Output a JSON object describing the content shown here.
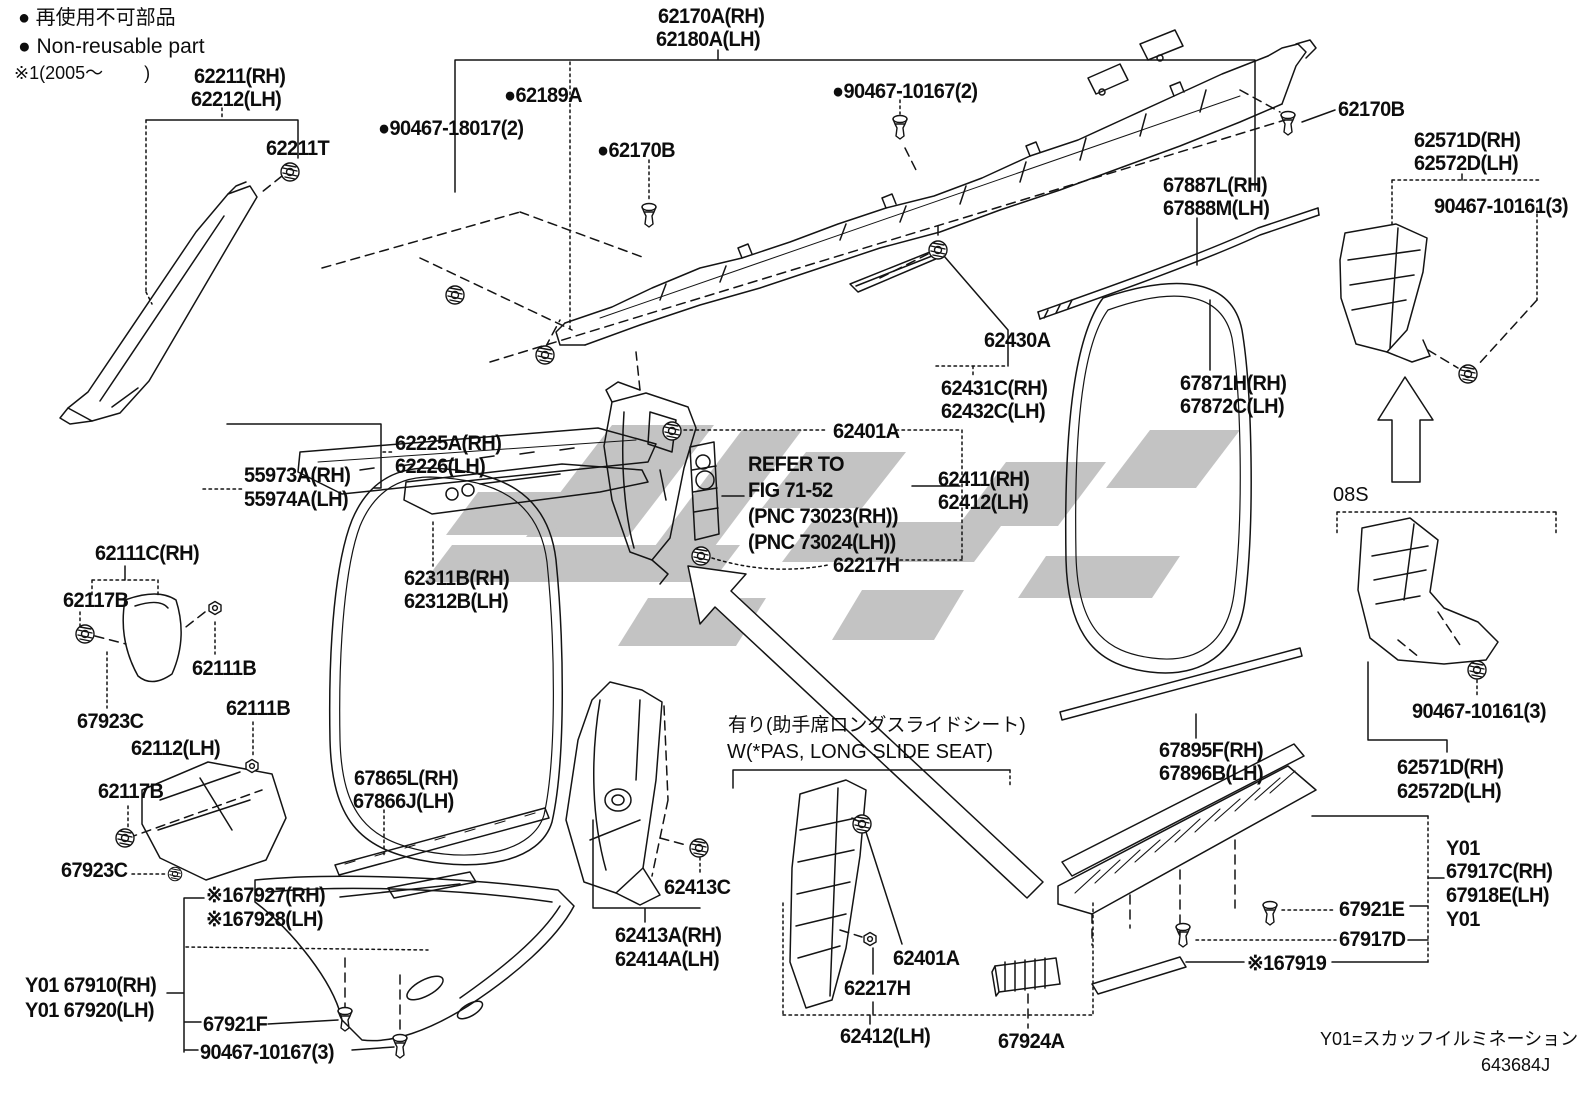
{
  "doc_type": "parts-diagram",
  "colors": {
    "line": "#141414",
    "watermark": "#c3c3c3",
    "background": "#ffffff"
  },
  "legend": {
    "nonreusable_jp": "● 再使用不可部品",
    "nonreusable_en": "● Non-reusable part",
    "note1": "※1(2005～　　　)"
  },
  "labels": [
    {
      "n": "legend-nonreusable-jp",
      "t": "● 再使用不可部品",
      "x": 18,
      "y": 8,
      "s": 20,
      "c": "note"
    },
    {
      "n": "legend-nonreusable-en",
      "t": "● Non-reusable part",
      "x": 18,
      "y": 36,
      "s": 21,
      "c": "note"
    },
    {
      "n": "legend-note1",
      "t": "※1(2005～　　 )",
      "x": 14,
      "y": 64,
      "s": 18,
      "c": "note"
    },
    {
      "n": "part-62211-rh",
      "t": "62211(RH)",
      "x": 194,
      "y": 66,
      "c": "part"
    },
    {
      "n": "part-62212-lh",
      "t": "62212(LH)",
      "x": 191,
      "y": 89,
      "c": "part"
    },
    {
      "n": "part-62211t",
      "t": "62211T",
      "x": 266,
      "y": 138,
      "c": "part"
    },
    {
      "n": "part-62170a-rh",
      "t": "62170A(RH)",
      "x": 658,
      "y": 6,
      "c": "part"
    },
    {
      "n": "part-62180a-lh",
      "t": "62180A(LH)",
      "x": 656,
      "y": 29,
      "c": "part"
    },
    {
      "n": "part-62189a",
      "t": "●62189A",
      "x": 504,
      "y": 85,
      "c": "part"
    },
    {
      "n": "part-90467-18017",
      "t": "●90467-18017(2)",
      "x": 378,
      "y": 118,
      "c": "part"
    },
    {
      "n": "part-62170b-left",
      "t": "●62170B",
      "x": 597,
      "y": 140,
      "c": "part"
    },
    {
      "n": "part-90467-10167-2",
      "t": "●90467-10167(2)",
      "x": 832,
      "y": 81,
      "c": "part"
    },
    {
      "n": "part-62170b-right",
      "t": "62170B",
      "x": 1338,
      "y": 99,
      "c": "part"
    },
    {
      "n": "part-62571d-rh-top",
      "t": "62571D(RH)",
      "x": 1414,
      "y": 130,
      "c": "part"
    },
    {
      "n": "part-62572d-lh-top",
      "t": "62572D(LH)",
      "x": 1414,
      "y": 153,
      "c": "part"
    },
    {
      "n": "part-90467-10161-top",
      "t": "90467-10161(3)",
      "x": 1434,
      "y": 196,
      "c": "part"
    },
    {
      "n": "part-67887l-rh",
      "t": "67887L(RH)",
      "x": 1163,
      "y": 175,
      "c": "part"
    },
    {
      "n": "part-67888m-lh",
      "t": "67888M(LH)",
      "x": 1163,
      "y": 198,
      "c": "part"
    },
    {
      "n": "part-62430a",
      "t": "62430A",
      "x": 984,
      "y": 330,
      "c": "part"
    },
    {
      "n": "part-62431c-rh",
      "t": "62431C(RH)",
      "x": 941,
      "y": 378,
      "c": "part"
    },
    {
      "n": "part-62432c-lh",
      "t": "62432C(LH)",
      "x": 941,
      "y": 401,
      "c": "part"
    },
    {
      "n": "part-67871h-rh",
      "t": "67871H(RH)",
      "x": 1180,
      "y": 373,
      "c": "part"
    },
    {
      "n": "part-67872c-lh",
      "t": "67872C(LH)",
      "x": 1180,
      "y": 396,
      "c": "part"
    },
    {
      "n": "part-62225a-rh",
      "t": "62225A(RH)",
      "x": 395,
      "y": 433,
      "c": "part"
    },
    {
      "n": "part-62226-lh",
      "t": "62226(LH)",
      "x": 395,
      "y": 456,
      "c": "part"
    },
    {
      "n": "part-55973a-rh",
      "t": "55973A(RH)",
      "x": 244,
      "y": 465,
      "c": "part"
    },
    {
      "n": "part-55974a-lh",
      "t": "55974A(LH)",
      "x": 244,
      "y": 489,
      "c": "part"
    },
    {
      "n": "part-62401a-top",
      "t": "62401A",
      "x": 833,
      "y": 421,
      "c": "part"
    },
    {
      "n": "ref-refer-to",
      "t": "REFER TO",
      "x": 748,
      "y": 454,
      "c": "part"
    },
    {
      "n": "ref-fig",
      "t": "FIG 71-52",
      "x": 748,
      "y": 480,
      "c": "part"
    },
    {
      "n": "ref-pnc-rh",
      "t": "(PNC 73023(RH))",
      "x": 748,
      "y": 506,
      "c": "part"
    },
    {
      "n": "ref-pnc-lh",
      "t": "(PNC 73024(LH))",
      "x": 748,
      "y": 532,
      "c": "part"
    },
    {
      "n": "part-62411-rh",
      "t": "62411(RH)",
      "x": 938,
      "y": 469,
      "c": "part"
    },
    {
      "n": "part-62412-lh-mid",
      "t": "62412(LH)",
      "x": 938,
      "y": 492,
      "c": "part"
    },
    {
      "n": "part-62217h-top",
      "t": "62217H",
      "x": 833,
      "y": 555,
      "c": "part"
    },
    {
      "n": "part-62111c-rh",
      "t": "62111C(RH)",
      "x": 95,
      "y": 543,
      "c": "part"
    },
    {
      "n": "part-62117b-1",
      "t": "62117B",
      "x": 63,
      "y": 590,
      "c": "part"
    },
    {
      "n": "part-62111b-1",
      "t": "62111B",
      "x": 192,
      "y": 658,
      "c": "part"
    },
    {
      "n": "part-67923c-1",
      "t": "67923C",
      "x": 77,
      "y": 711,
      "c": "part"
    },
    {
      "n": "part-62111b-2",
      "t": "62111B",
      "x": 226,
      "y": 698,
      "c": "part"
    },
    {
      "n": "part-62112-lh",
      "t": "62112(LH)",
      "x": 131,
      "y": 738,
      "c": "part"
    },
    {
      "n": "part-62117b-2",
      "t": "62117B",
      "x": 98,
      "y": 781,
      "c": "part"
    },
    {
      "n": "part-67923c-2",
      "t": "67923C",
      "x": 61,
      "y": 860,
      "c": "part"
    },
    {
      "n": "part-62311b-rh",
      "t": "62311B(RH)",
      "x": 404,
      "y": 568,
      "c": "part"
    },
    {
      "n": "part-62312b-lh",
      "t": "62312B(LH)",
      "x": 404,
      "y": 591,
      "c": "part"
    },
    {
      "n": "part-67865l-rh",
      "t": "67865L(RH)",
      "x": 354,
      "y": 768,
      "c": "part"
    },
    {
      "n": "part-67866j-lh",
      "t": "67866J(LH)",
      "x": 353,
      "y": 791,
      "c": "part"
    },
    {
      "n": "part-67927-rh",
      "t": "※167927(RH)",
      "x": 206,
      "y": 885,
      "c": "part"
    },
    {
      "n": "part-67928-lh",
      "t": "※167928(LH)",
      "x": 206,
      "y": 909,
      "c": "part"
    },
    {
      "n": "part-y01-67910-rh",
      "t": "Y01 67910(RH)",
      "x": 25,
      "y": 975,
      "c": "part"
    },
    {
      "n": "part-y01-67920-lh",
      "t": "Y01 67920(LH)",
      "x": 25,
      "y": 1000,
      "c": "part"
    },
    {
      "n": "part-67921f",
      "t": "67921F",
      "x": 203,
      "y": 1014,
      "c": "part"
    },
    {
      "n": "part-90467-10167-3",
      "t": "90467-10167(3)",
      "x": 200,
      "y": 1042,
      "c": "part"
    },
    {
      "n": "part-62413c",
      "t": "62413C",
      "x": 664,
      "y": 877,
      "c": "part"
    },
    {
      "n": "part-62413a-rh",
      "t": "62413A(RH)",
      "x": 615,
      "y": 925,
      "c": "part"
    },
    {
      "n": "part-62414a-lh",
      "t": "62414A(LH)",
      "x": 615,
      "y": 949,
      "c": "part"
    },
    {
      "n": "note-long-slide-jp",
      "t": "有り(助手席ロングスライドシート)",
      "x": 728,
      "y": 716,
      "s": 19,
      "c": "note"
    },
    {
      "n": "note-long-slide-en",
      "t": "W(*PAS, LONG SLIDE SEAT)",
      "x": 727,
      "y": 742,
      "s": 20,
      "c": "note"
    },
    {
      "n": "part-62401a-bottom",
      "t": "62401A",
      "x": 893,
      "y": 948,
      "c": "part"
    },
    {
      "n": "part-62217h-bottom",
      "t": "62217H",
      "x": 844,
      "y": 978,
      "c": "part"
    },
    {
      "n": "part-62412-lh-bottom",
      "t": "62412(LH)",
      "x": 840,
      "y": 1026,
      "c": "part"
    },
    {
      "n": "part-67924a",
      "t": "67924A",
      "x": 998,
      "y": 1031,
      "c": "part"
    },
    {
      "n": "part-67895f-rh",
      "t": "67895F(RH)",
      "x": 1159,
      "y": 740,
      "c": "part"
    },
    {
      "n": "part-67896b-lh",
      "t": "67896B(LH)",
      "x": 1159,
      "y": 763,
      "c": "part"
    },
    {
      "n": "note-08s",
      "t": "08S",
      "x": 1333,
      "y": 485,
      "s": 20,
      "c": "note"
    },
    {
      "n": "part-90467-10161-bottom",
      "t": "90467-10161(3)",
      "x": 1412,
      "y": 701,
      "c": "part"
    },
    {
      "n": "part-62571d-rh-bottom",
      "t": "62571D(RH)",
      "x": 1397,
      "y": 757,
      "c": "part"
    },
    {
      "n": "part-62572d-lh-bottom",
      "t": "62572D(LH)",
      "x": 1397,
      "y": 781,
      "c": "part"
    },
    {
      "n": "part-y01-a",
      "t": "Y01",
      "x": 1446,
      "y": 838,
      "c": "part"
    },
    {
      "n": "part-67917c-rh",
      "t": "67917C(RH)",
      "x": 1446,
      "y": 861,
      "c": "part"
    },
    {
      "n": "part-67918e-lh",
      "t": "67918E(LH)",
      "x": 1446,
      "y": 885,
      "c": "part"
    },
    {
      "n": "part-y01-b",
      "t": "Y01",
      "x": 1446,
      "y": 909,
      "c": "part"
    },
    {
      "n": "part-67921e",
      "t": "67921E",
      "x": 1339,
      "y": 899,
      "c": "part"
    },
    {
      "n": "part-67917d",
      "t": "67917D",
      "x": 1339,
      "y": 929,
      "c": "part"
    },
    {
      "n": "part-67919",
      "t": "※167919",
      "x": 1247,
      "y": 953,
      "c": "part"
    },
    {
      "n": "footer-y01-note",
      "t": "Y01=スカッフイルミネーション",
      "x": 1320,
      "y": 1030,
      "s": 18,
      "c": "note"
    },
    {
      "n": "footer-doc-number",
      "t": "643684J",
      "x": 1481,
      "y": 1056,
      "s": 18,
      "c": "note"
    }
  ]
}
